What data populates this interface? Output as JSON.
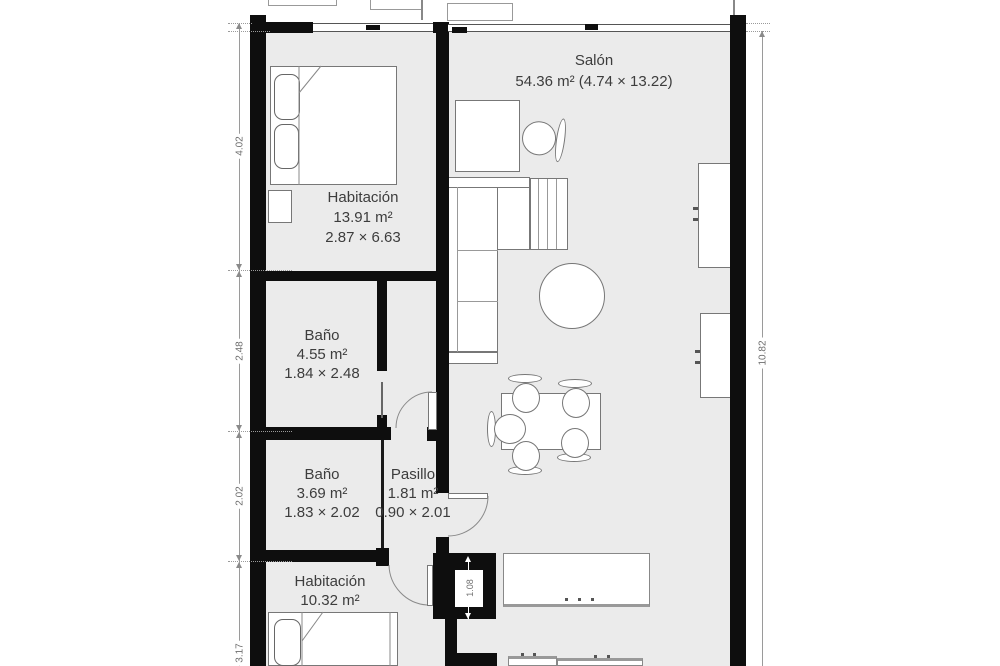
{
  "floorplan": {
    "rooms": {
      "salon": {
        "name": "Salón",
        "details": "54.36 m² (4.74 × 13.22)"
      },
      "bedroom_top": {
        "name": "Habitación",
        "area": "13.91 m²",
        "size": "2.87 × 6.63"
      },
      "bathroom_large": {
        "name": "Baño",
        "area": "4.55 m²",
        "size": "1.84 × 2.48"
      },
      "bathroom_small": {
        "name": "Baño",
        "area": "3.69 m²",
        "size": "1.83 × 2.02"
      },
      "hallway": {
        "name": "Pasillo",
        "area": "1.81 m²",
        "size": "0.90 × 2.01"
      },
      "bedroom_bottom": {
        "name": "Habitación",
        "area": "10.32 m²"
      }
    },
    "dimensions": {
      "left": [
        "4.02",
        "2.48",
        "2.02",
        "3.17"
      ],
      "right": "10.82",
      "column": "1.08"
    },
    "colors": {
      "wall": "#0e0e0e",
      "floor": "#ebebeb",
      "label_text": "#3d3d3d",
      "dimension_text": "#6e6e6e"
    }
  }
}
